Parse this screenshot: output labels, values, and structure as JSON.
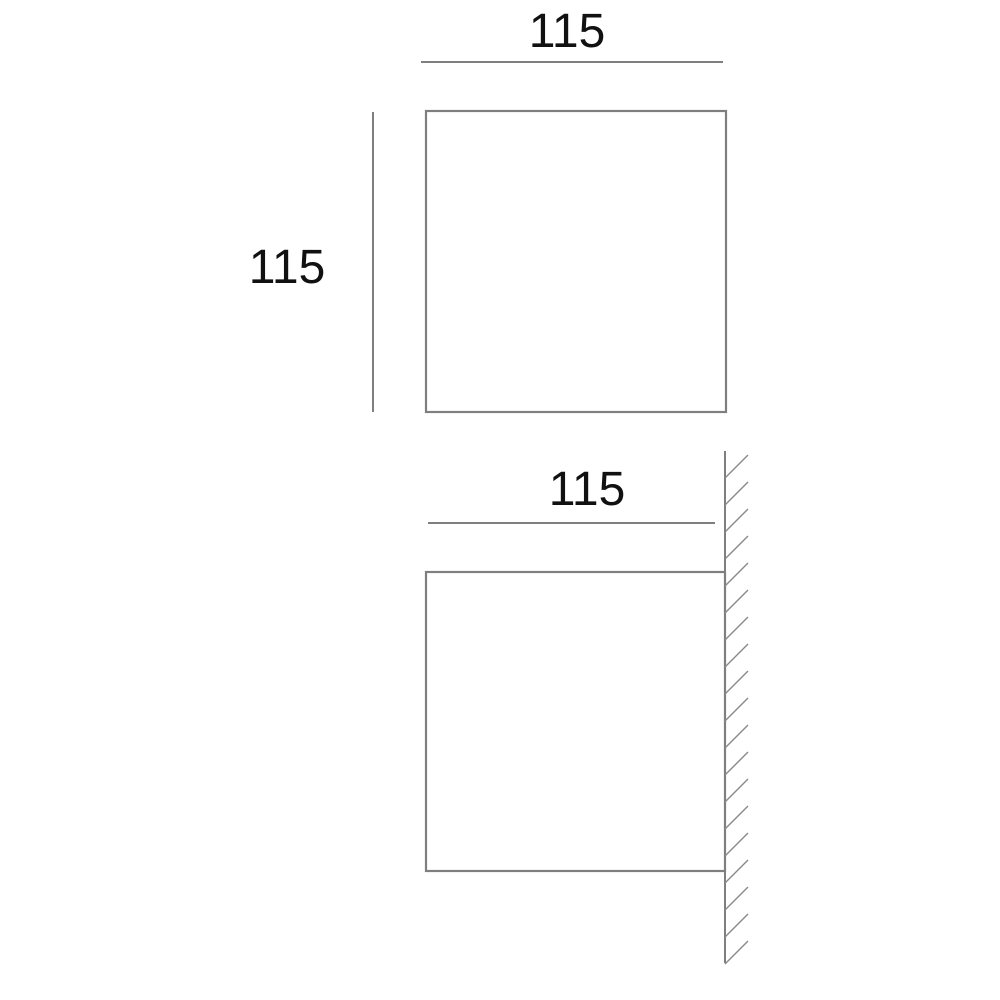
{
  "colors": {
    "line": "#7f7f7f",
    "hatch": "#8a8a8a",
    "text": "#111111",
    "background": "#ffffff"
  },
  "diagram": {
    "front_view": {
      "width_label": "115",
      "height_label": "115"
    },
    "side_view": {
      "width_label": "115",
      "wall_hatch_count": 19
    }
  }
}
